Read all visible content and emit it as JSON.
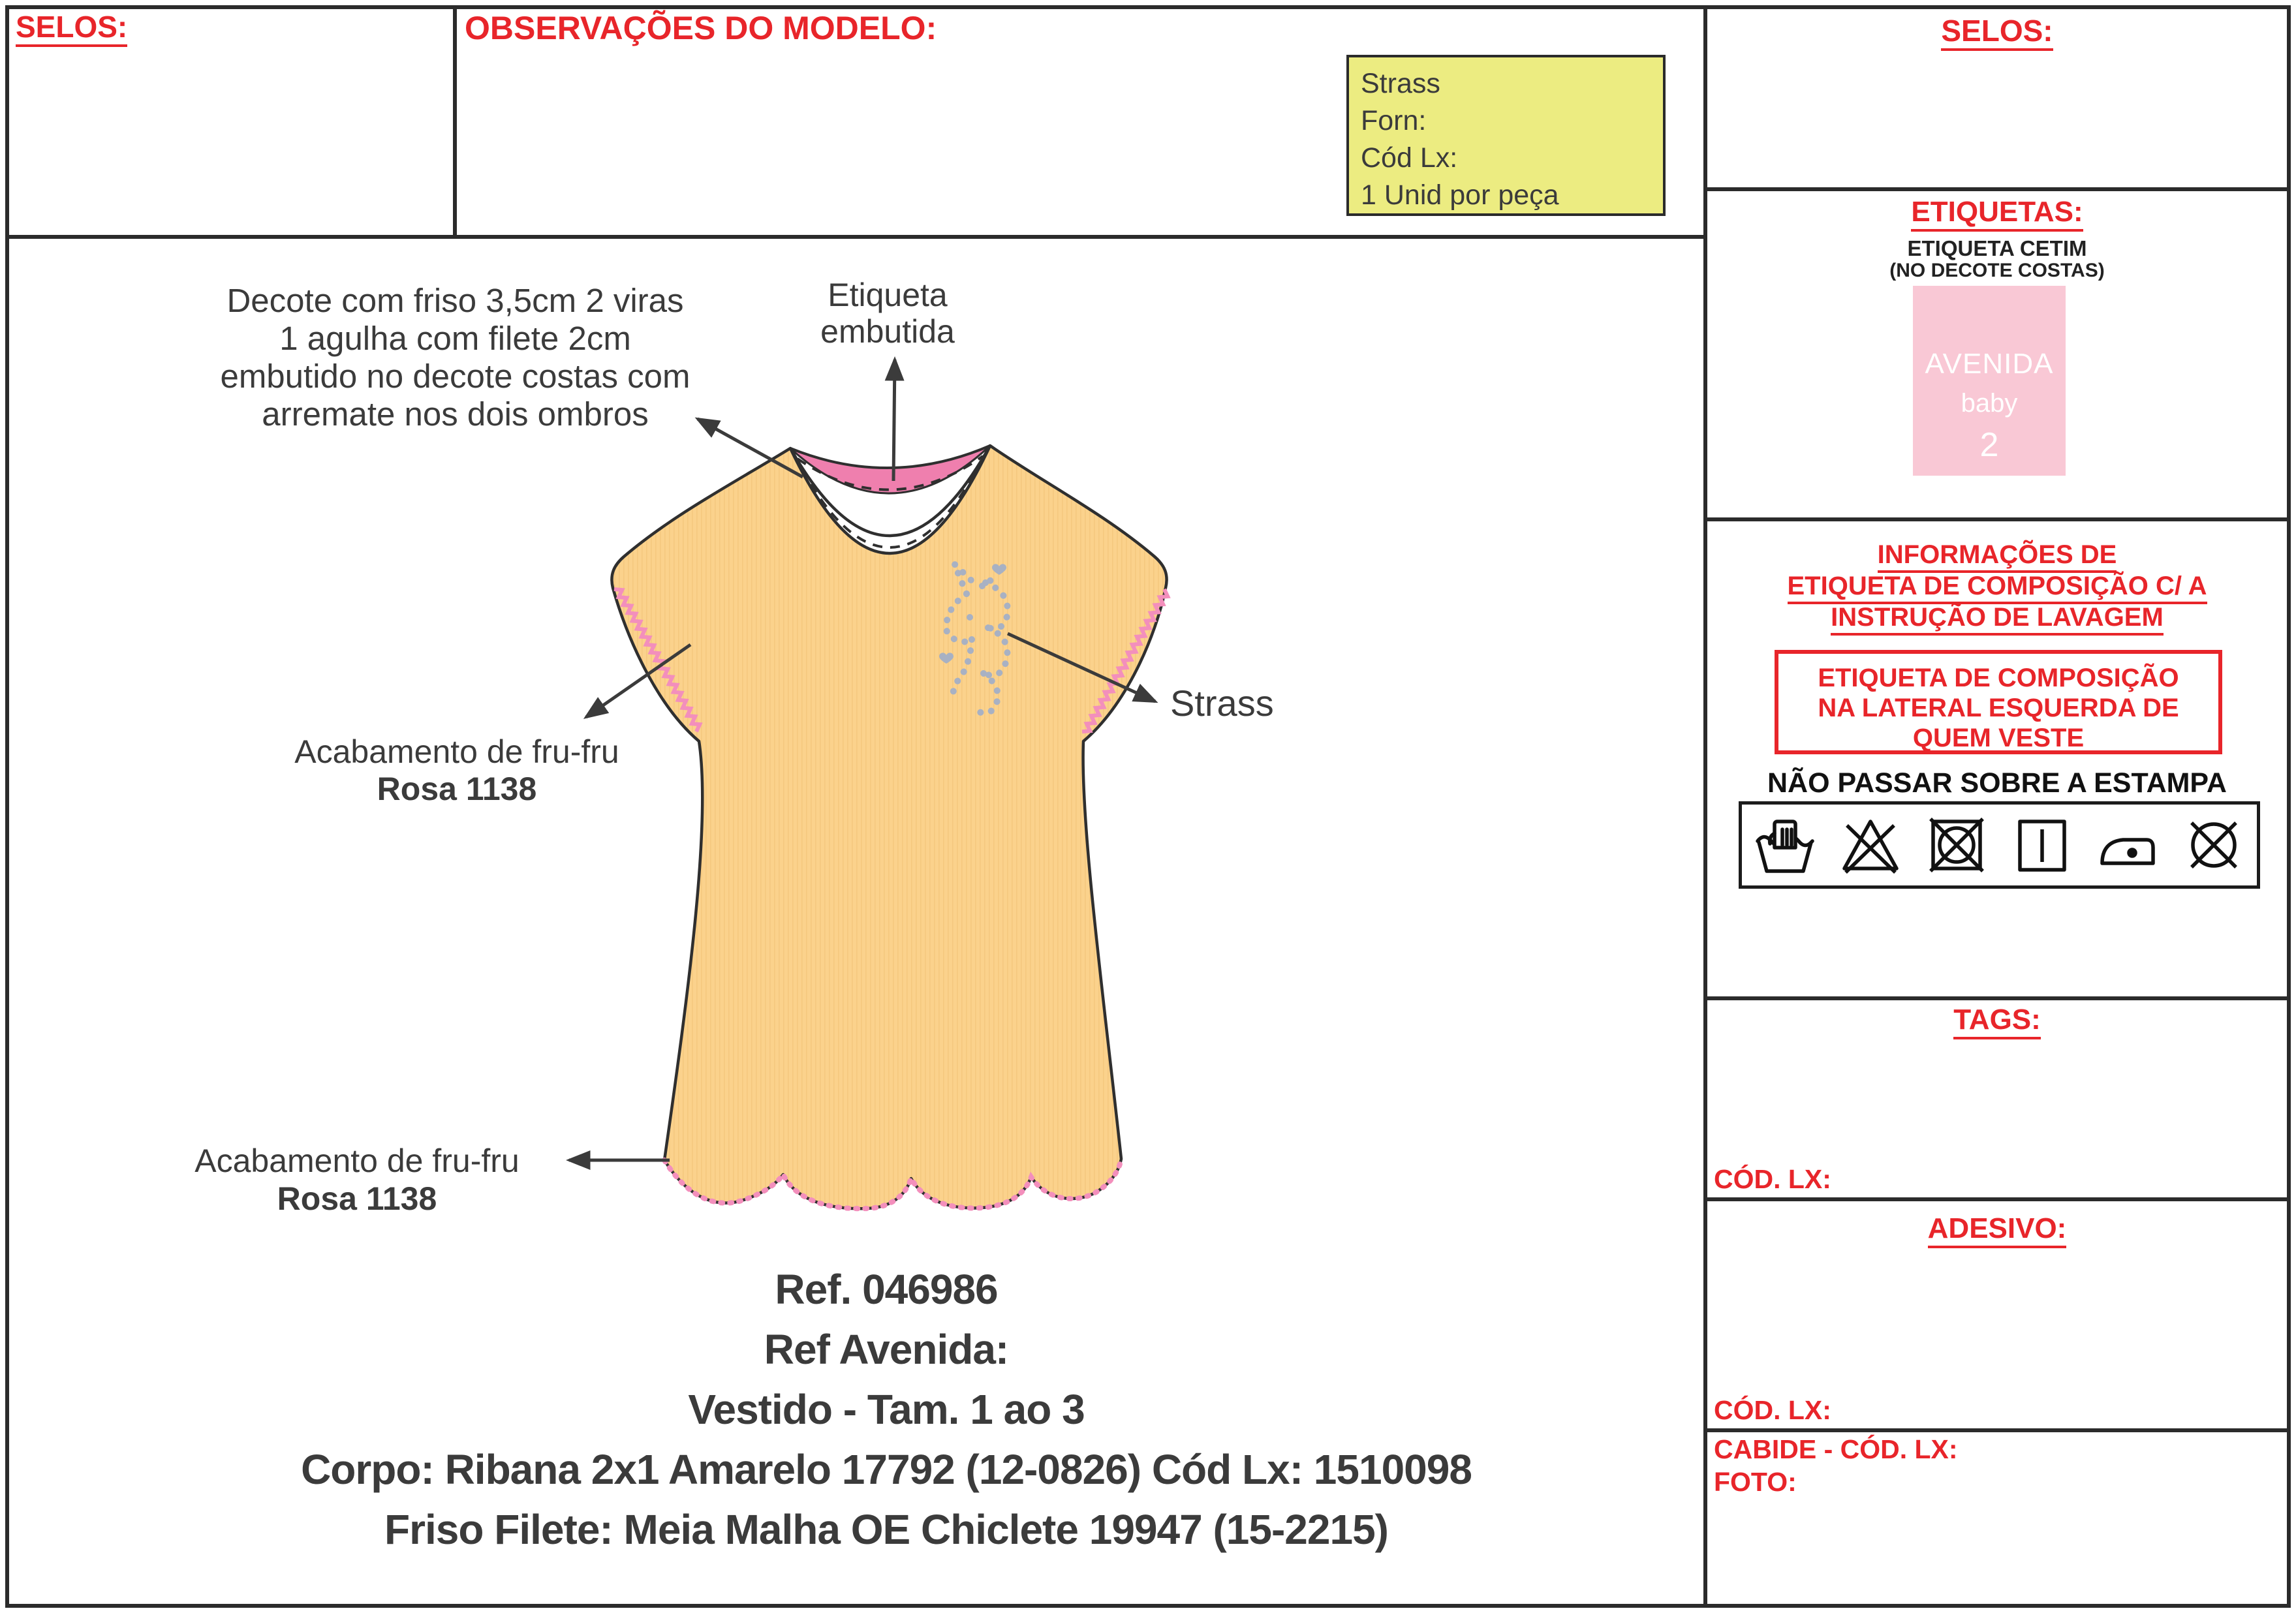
{
  "colors": {
    "accent_red": "#e8252a",
    "note_yellow": "#ecec81",
    "label_pink": "#f9c8d5",
    "dress_yellow": "#fbd28c",
    "trim_pink": "#f38fbc",
    "neck_band_pink": "#ef7fae",
    "strass_gray": "#a8b1c3",
    "line_dark": "#2f2f2f"
  },
  "top": {
    "selos": "SELOS:",
    "observacoes": "OBSERVAÇÕES DO MODELO:",
    "note_lines": [
      "Strass",
      "Forn:",
      "Cód Lx:",
      "1 Unid por peça"
    ]
  },
  "right": {
    "selos": "SELOS:",
    "etiquetas": "ETIQUETAS:",
    "etiqueta_sub1": "ETIQUETA CETIM",
    "etiqueta_sub2": "(NO DECOTE COSTAS)",
    "label_brand": "AVENIDA",
    "label_line2": "baby",
    "label_size": "2",
    "info_l1": "INFORMAÇÕES DE",
    "info_l2": "ETIQUETA DE COMPOSIÇÃO C/ A",
    "info_l3": "INSTRUÇÃO DE LAVAGEM",
    "box_l1": "ETIQUETA DE COMPOSIÇÃO",
    "box_l2": "NA LATERAL ESQUERDA DE",
    "box_l3": "QUEM VESTE",
    "estampa": "NÃO PASSAR SOBRE A ESTAMPA",
    "care_symbols": [
      "hand-wash",
      "do-not-bleach",
      "do-not-tumble-dry",
      "line-dry",
      "iron-one-dot",
      "do-not-dry-clean"
    ],
    "tags": "TAGS:",
    "cod_lx_tags": "CÓD. LX:",
    "adesivo": "ADESIVO:",
    "cod_lx_adesivo": "CÓD. LX:",
    "cabide": "CABIDE - CÓD. LX:",
    "foto": "FOTO:"
  },
  "drawing": {
    "decote_l1": "Decote com friso 3,5cm 2 viras",
    "decote_l2": "1 agulha com filete 2cm",
    "decote_l3": "embutido no decote costas com",
    "decote_l4": "arremate nos dois ombros",
    "etiqueta_l1": "Etiqueta",
    "etiqueta_l2": "embutida",
    "strass": "Strass",
    "frufru_sleeve_l1": "Acabamento de fru-fru",
    "frufru_sleeve_l2": "Rosa 1138",
    "frufru_hem_l1": "Acabamento de fru-fru",
    "frufru_hem_l2": "Rosa 1138"
  },
  "footer": {
    "lines": [
      "Ref. 046986",
      "Ref Avenida:",
      "Vestido - Tam. 1 ao 3",
      "Corpo: Ribana 2x1 Amarelo 17792 (12-0826) Cód Lx: 1510098",
      "Friso Filete: Meia Malha OE Chiclete 19947 (15-2215)"
    ]
  }
}
